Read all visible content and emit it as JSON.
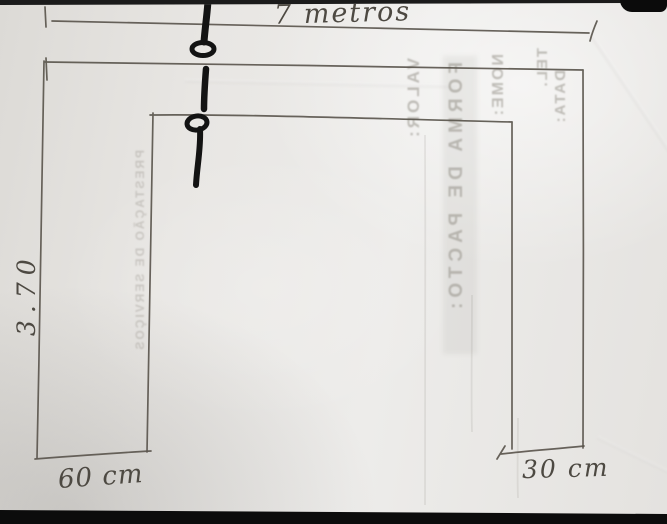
{
  "sketch": {
    "dimensions": {
      "top": "7 metros",
      "left_height": "3.70",
      "bottom_left": "60 cm",
      "bottom_right": "30 cm"
    },
    "bleedthrough": {
      "valor": "VALOR:",
      "forma": "FORMA DE PACTO:",
      "nome": "NOME:",
      "tel": "TEL.",
      "data": "DATA:",
      "prestacao": "PRESTAÇÃO DE SERVIÇOS"
    },
    "colors": {
      "paper": "#e8e6e3",
      "pencil": "#5b564e",
      "marker": "#131313",
      "background": "#101010",
      "bleed_text": "#948f87"
    }
  }
}
